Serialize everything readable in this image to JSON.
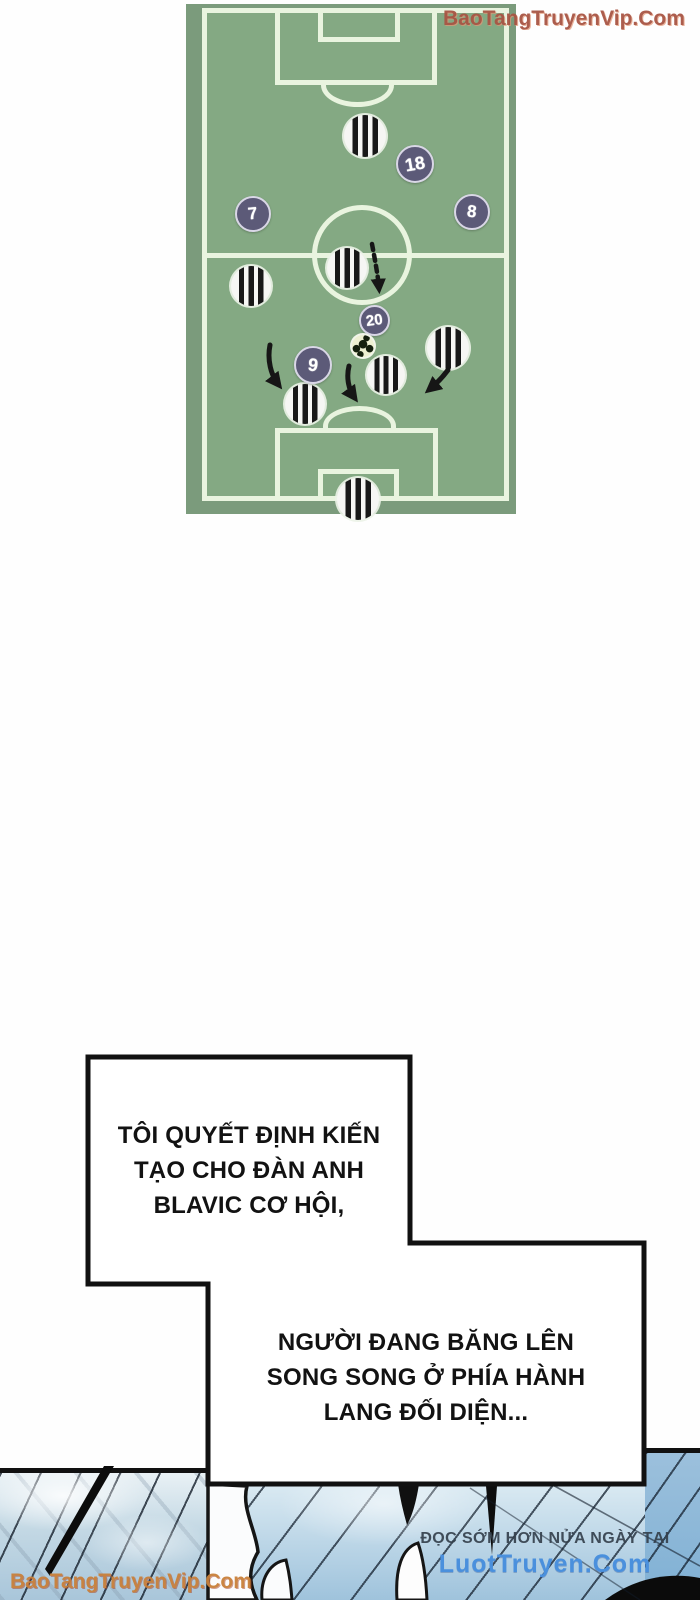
{
  "watermark_top_right": {
    "text": "BaoTangTruyenVip.Com",
    "color": "#a85544"
  },
  "watermark_bottom_left": {
    "text": "BaoTangTruyenVip.Com",
    "color": "#c9803a"
  },
  "field": {
    "colors": {
      "grass": "#84a983",
      "margin": "#7b9b7c",
      "line": "#e9f4df",
      "team_circle": "#5c5a78"
    },
    "striped_players": [
      {
        "x": 179,
        "y": 132,
        "d": 42
      },
      {
        "x": 161,
        "y": 264,
        "d": 40
      },
      {
        "x": 65,
        "y": 282,
        "d": 40
      },
      {
        "x": 262,
        "y": 344,
        "d": 42
      },
      {
        "x": 200,
        "y": 371,
        "d": 38
      },
      {
        "x": 119,
        "y": 400,
        "d": 40
      },
      {
        "x": 172,
        "y": 495,
        "d": 42
      }
    ],
    "numbered_players": [
      {
        "x": 67,
        "y": 210,
        "d": 36,
        "label": "7",
        "tilt": -6
      },
      {
        "x": 229,
        "y": 160,
        "d": 38,
        "label": "18",
        "tilt": -10
      },
      {
        "x": 286,
        "y": 208,
        "d": 36,
        "label": "8",
        "tilt": 6
      },
      {
        "x": 188,
        "y": 316,
        "d": 31,
        "label": "20",
        "tilt": -8
      },
      {
        "x": 127,
        "y": 361,
        "d": 38,
        "label": "9",
        "tilt": 8
      }
    ],
    "ball": {
      "x": 177,
      "y": 342,
      "d": 22
    }
  },
  "bubbles": [
    {
      "lines": [
        "TÔI QUYẾT ĐỊNH KIẾN",
        "TẠO CHO ĐÀN ANH",
        "BLAVIC CƠ HỘI,"
      ]
    },
    {
      "lines": [
        "NGƯỜI ĐANG BĂNG LÊN",
        "SONG SONG Ở PHÍA HÀNH",
        "LANG ĐỐI DIỆN..."
      ]
    }
  ],
  "footer": {
    "promo_top": "ĐỌC SỚM HƠN NỬA NGÀY TẠI",
    "promo_site": "LuotTruyen.Com",
    "site_color": "#4a90dd"
  }
}
